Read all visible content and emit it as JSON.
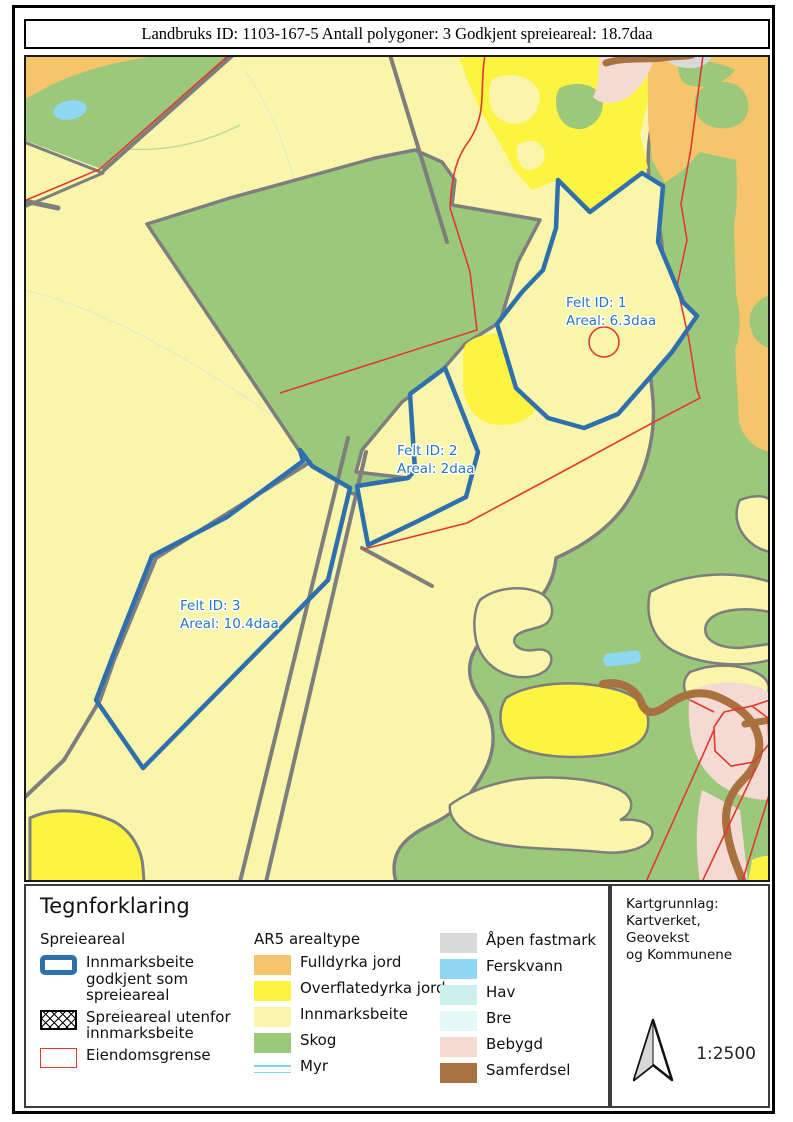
{
  "title": "Landbruks ID: 1103-167-5 Antall polygoner: 3 Godkjent spreieareal: 18.7daa",
  "map": {
    "labels": [
      {
        "line1": "Felt ID: 1",
        "line2": "Areal: 6.3daa"
      },
      {
        "line1": "Felt ID: 2",
        "line2": "Areal: 2daa"
      },
      {
        "line1": "Felt ID: 3",
        "line2": "Areal: 10.4daa"
      }
    ]
  },
  "legend": {
    "title": "Tegnforklaring",
    "spreieareal": {
      "header": "Spreieareal",
      "items": [
        {
          "label": "Innmarksbeite godkjent som spreieareal",
          "swatch": "blue-outline"
        },
        {
          "label": "Spreieareal utenfor innmarksbeite",
          "swatch": "crosshatch"
        },
        {
          "label": "Eiendomsgrense",
          "swatch": "red-outline"
        }
      ]
    },
    "ar5": {
      "header": "AR5 arealtype",
      "items": [
        {
          "label": "Fulldyrka jord",
          "color_key": "fulldyrka"
        },
        {
          "label": "Overflatedyrka jord",
          "color_key": "overflatedyrka"
        },
        {
          "label": "Innmarksbeite",
          "color_key": "innmarksbeite"
        },
        {
          "label": "Skog",
          "color_key": "skog"
        },
        {
          "label": "Myr",
          "color_key": "myr_line"
        }
      ]
    },
    "ar5_col2": {
      "items": [
        {
          "label": "Åpen fastmark",
          "color_key": "apen_fastmark"
        },
        {
          "label": "Ferskvann",
          "color_key": "ferskvann"
        },
        {
          "label": "Hav",
          "color_key": "hav"
        },
        {
          "label": "Bre",
          "color_key": "bre"
        },
        {
          "label": "Bebygd",
          "color_key": "bebygd"
        },
        {
          "label": "Samferdsel",
          "color_key": "samferdsel"
        }
      ]
    }
  },
  "info_box": {
    "source_lines": [
      "Kartgrunnlag:",
      "Kartverket, Geovekst",
      "og Kommunene"
    ],
    "scale": "1:2500"
  },
  "colors": {
    "fulldyrka": "#F6C46A",
    "overflatedyrka": "#FCF441",
    "innmarksbeite": "#F9F6AC",
    "skog": "#9CC87B",
    "myr_line": "#7FD4E8",
    "apen_fastmark": "#D9D9D9",
    "ferskvann": "#8FD7F3",
    "hav": "#CBF0EE",
    "bre": "#E4F9F7",
    "bebygd": "#F5D9D3",
    "samferdsel": "#A9713F",
    "spreieareal_blue": "#2E6FAE",
    "eiendomsgrense_red": "#E0392E",
    "boundary_grey": "#7E7E7E",
    "label_blue": "#2878BE"
  }
}
